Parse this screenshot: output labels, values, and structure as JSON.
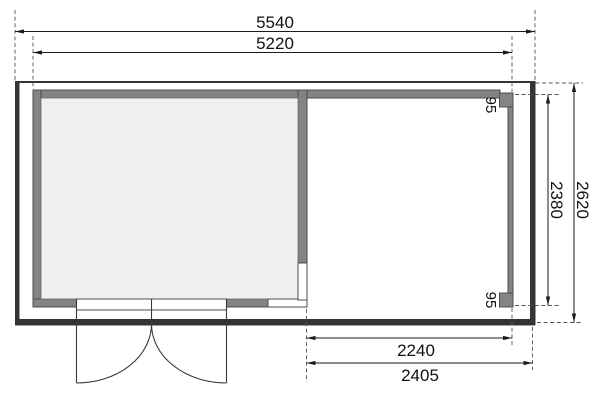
{
  "drawing": {
    "dims": {
      "width_overall": {
        "label": "5540"
      },
      "width_inner": {
        "label": "5220"
      },
      "height_overall": {
        "label": "2620"
      },
      "height_inner": {
        "label": "2380"
      },
      "terrace_inner": {
        "label": "2240"
      },
      "terrace_overall": {
        "label": "2405"
      },
      "post_top": {
        "label": "95"
      },
      "post_bottom": {
        "label": "95"
      }
    },
    "colors": {
      "roof_outline": "#343434",
      "wall_gray": "#848484",
      "wall_edge": "#4d4d4d",
      "floor_fill": "#f0f0f0",
      "dimension_line": "#1a1a1a",
      "background": "#ffffff"
    }
  }
}
